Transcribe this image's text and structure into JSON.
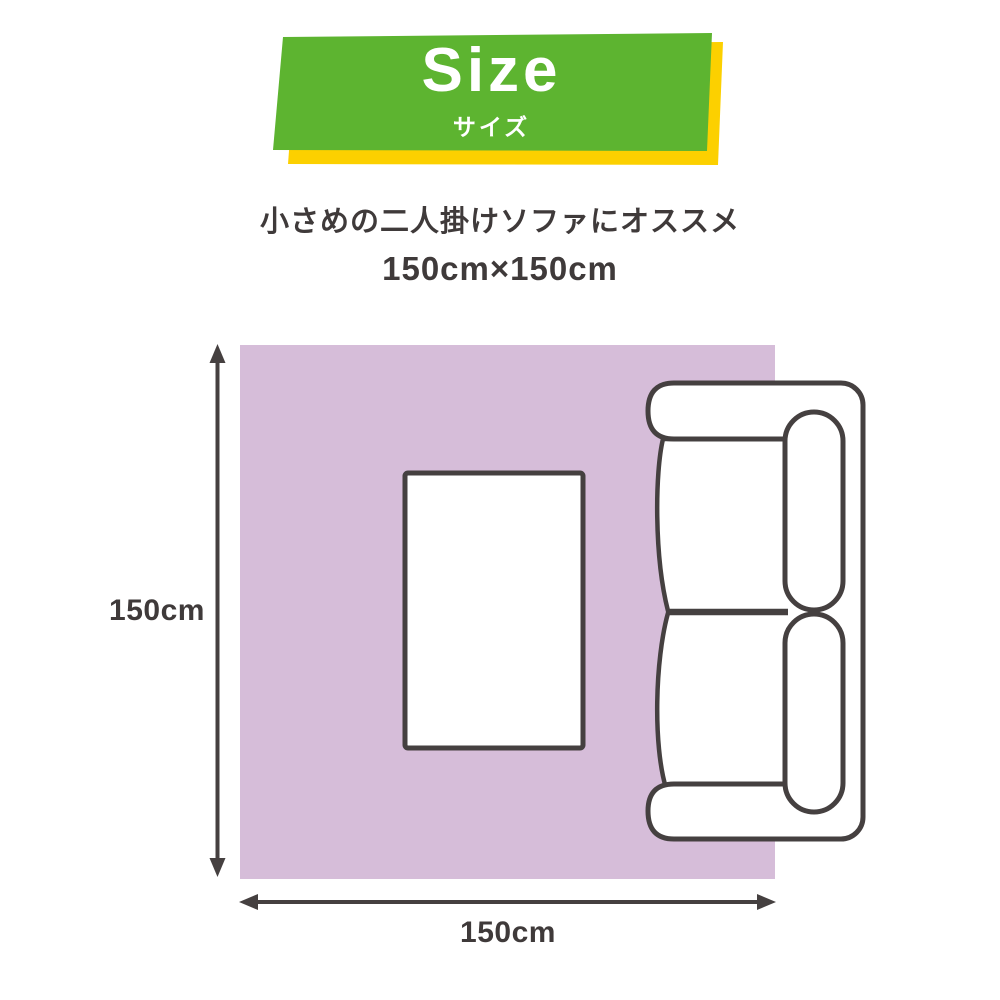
{
  "banner": {
    "title": "Size",
    "subtitle": "サイズ",
    "green_color": "#5db430",
    "shadow_color": "#fcd000"
  },
  "description": {
    "line1": "小さめの二人掛けソファにオススメ",
    "line2": "150cm×150cm"
  },
  "diagram": {
    "rug_color": "#d6bdd9",
    "line_color": "#454040",
    "text_color": "#3f3a3a",
    "height_label": "150cm",
    "width_label": "150cm"
  }
}
